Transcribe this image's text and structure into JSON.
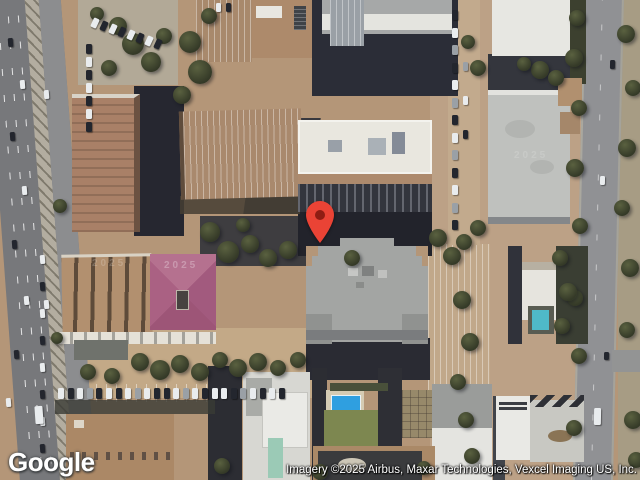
{
  "branding": {
    "logo_text": "Google"
  },
  "attribution": {
    "text": "Imagery ©2025 Airbus, Maxar Technologies, Vexcel Imaging US, Inc."
  },
  "watermarks": {
    "year": "2025"
  },
  "marker": {
    "color": "#EA4335",
    "dot_color": "#8F1D13"
  }
}
